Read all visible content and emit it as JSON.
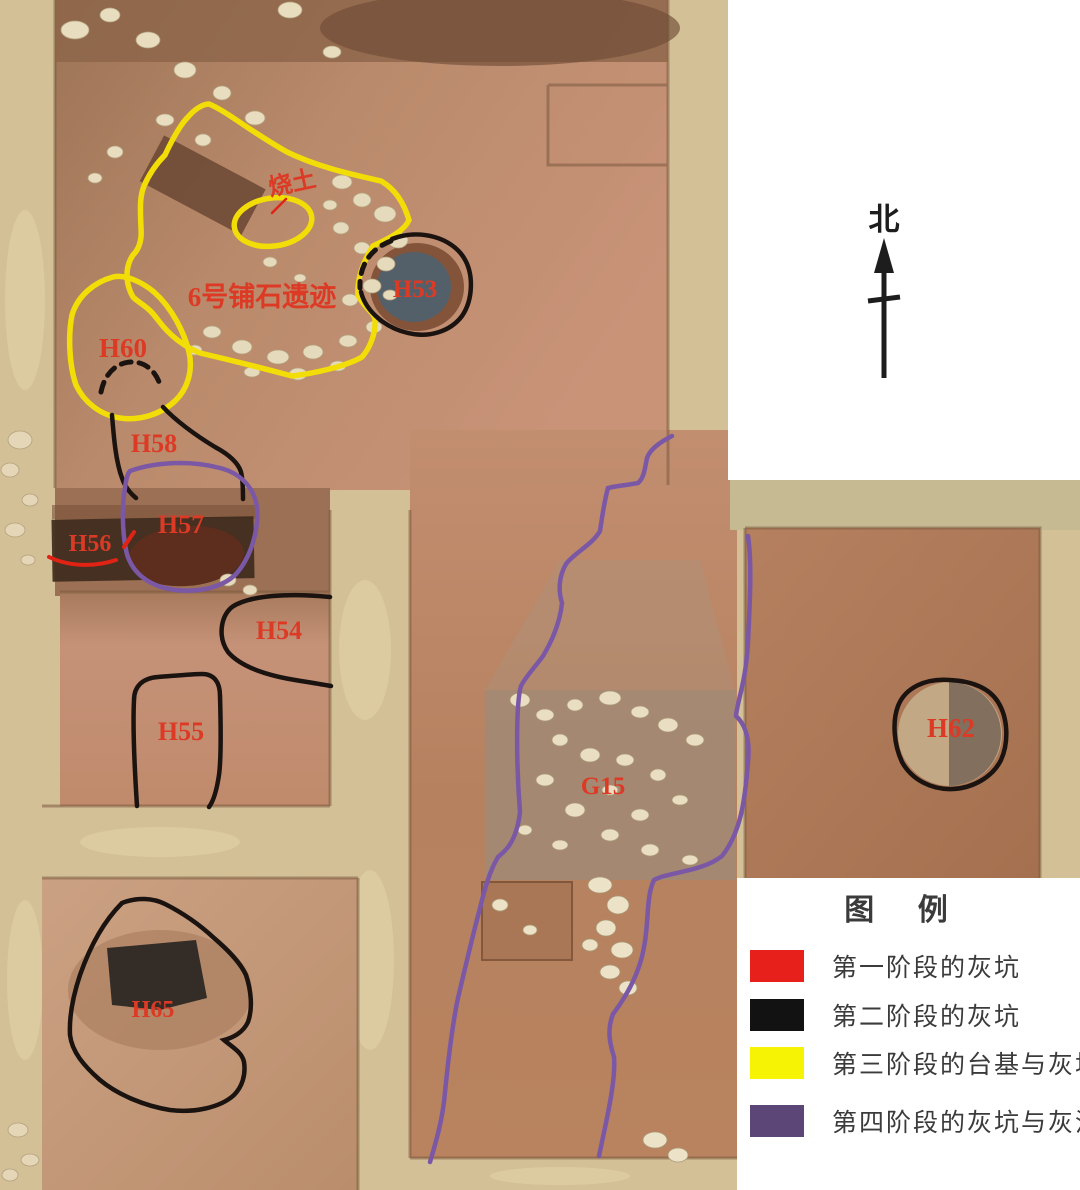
{
  "north": {
    "label": "北"
  },
  "features": {
    "shaotu": {
      "label": "烧土"
    },
    "platform": {
      "label": "6号铺石遗迹"
    },
    "h53": {
      "label": "H53"
    },
    "h60": {
      "label": "H60"
    },
    "h58": {
      "label": "H58"
    },
    "h57": {
      "label": "H57"
    },
    "h56": {
      "label": "H56"
    },
    "h54": {
      "label": "H54"
    },
    "h55": {
      "label": "H55"
    },
    "h65": {
      "label": "H65"
    },
    "g15": {
      "label": "G15"
    },
    "h62": {
      "label": "H62"
    }
  },
  "legend": {
    "title": "图  例",
    "items": [
      {
        "label": "第一阶段的灰坑",
        "color": "#e8201c"
      },
      {
        "label": "第二阶段的灰坑",
        "color": "#121212"
      },
      {
        "label": "第三阶段的台基与灰坑",
        "color": "#f6f304"
      },
      {
        "label": "第四阶段的灰坑与灰沟",
        "color": "#5c4677"
      }
    ]
  },
  "colors": {
    "label_red": "#dd3a26",
    "outline_yellow": "#f2dd07",
    "outline_black": "#1b1310",
    "outline_purple": "#7b58a6",
    "outline_red": "#e02315",
    "north_ink": "#1d1d1d"
  }
}
